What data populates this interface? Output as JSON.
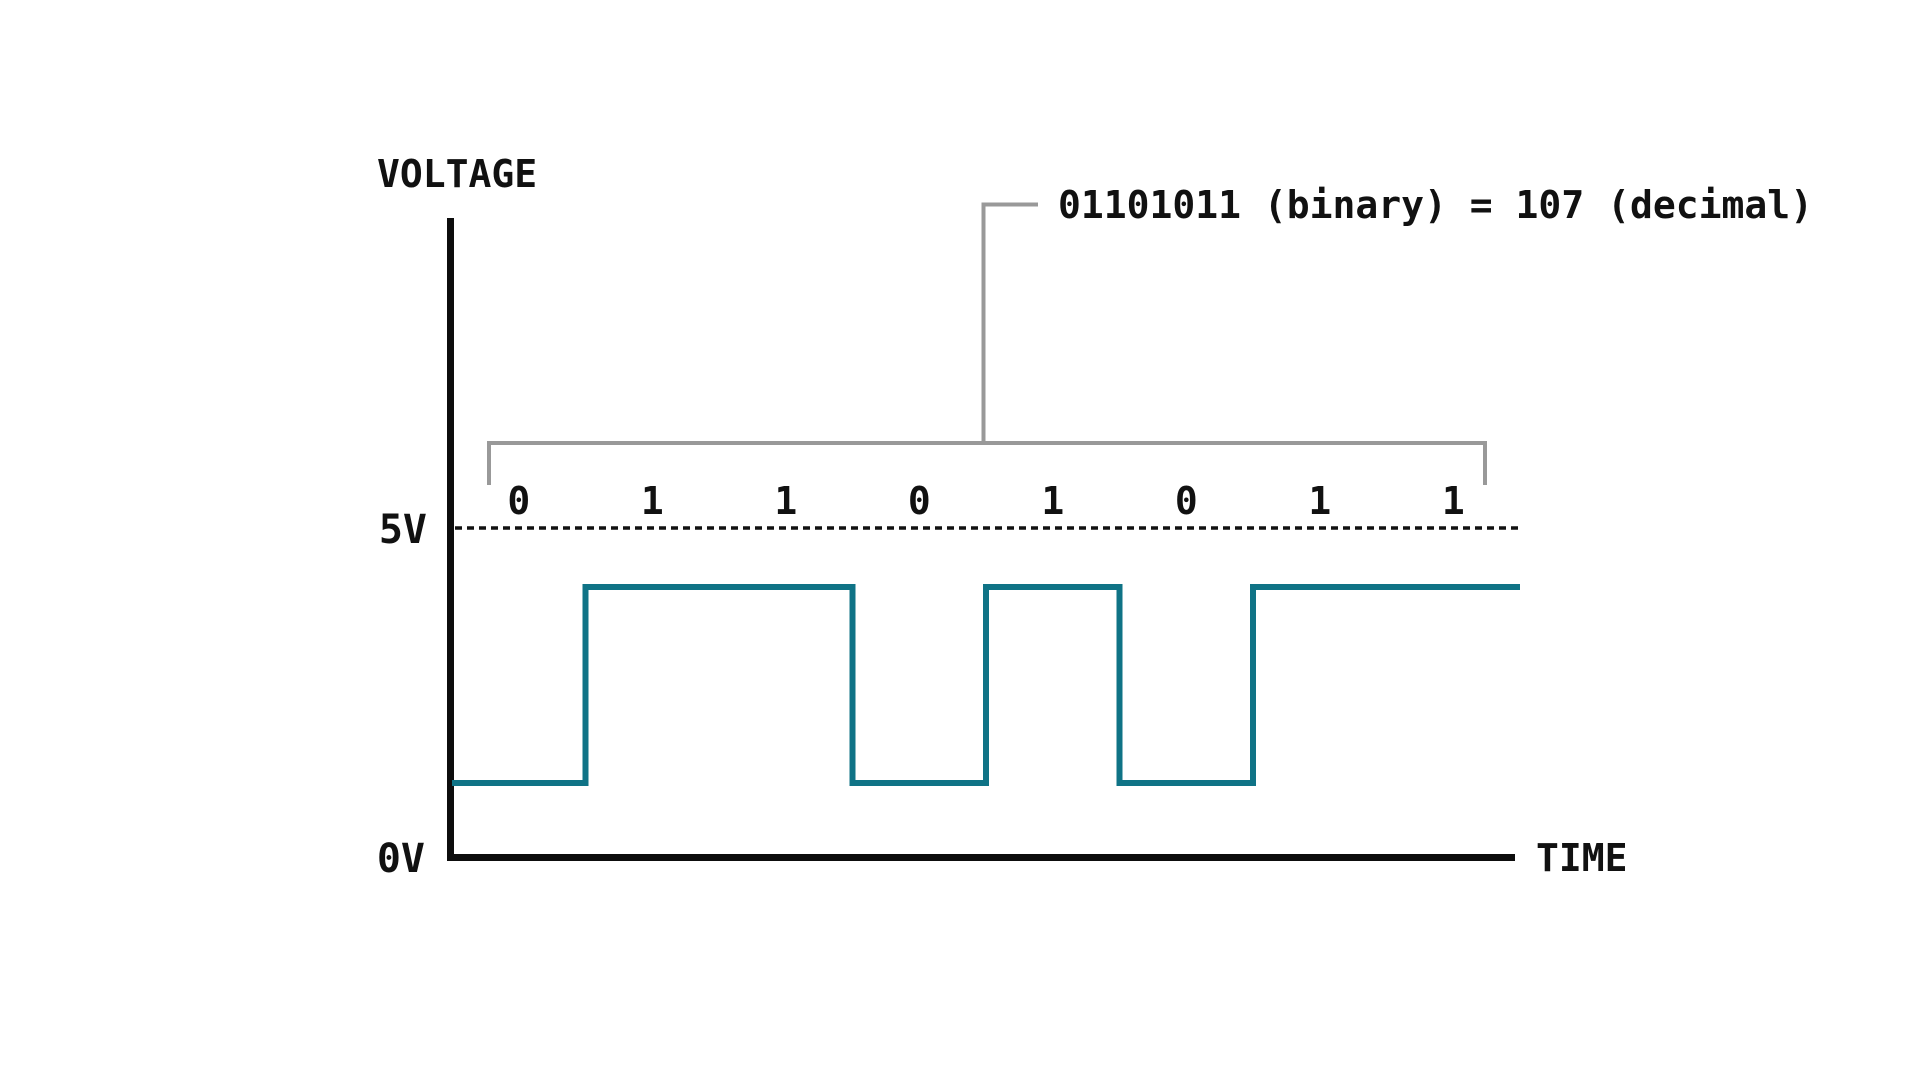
{
  "chart_data": {
    "type": "line",
    "subtype": "digital-square-wave",
    "title": "01101011 (binary) = 107 (decimal)",
    "binary": "01101011",
    "decimal": 107,
    "bits": [
      "0",
      "1",
      "1",
      "0",
      "1",
      "0",
      "1",
      "1"
    ],
    "bit_levels": [
      0,
      1,
      1,
      0,
      1,
      0,
      1,
      1
    ],
    "ylabel": "VOLTAGE",
    "xlabel": "TIME",
    "yticks": [
      {
        "label": "5V",
        "value": 5
      },
      {
        "label": "0V",
        "value": 0
      }
    ],
    "high_voltage": 5,
    "low_voltage": 0,
    "grid": "off",
    "reference_line": "dashed line at 5V",
    "colors": {
      "waveform": "#0f7386",
      "axis": "#0d0d0d",
      "text": "#111111",
      "bracket": "#999999",
      "background": "#ffffff"
    }
  }
}
